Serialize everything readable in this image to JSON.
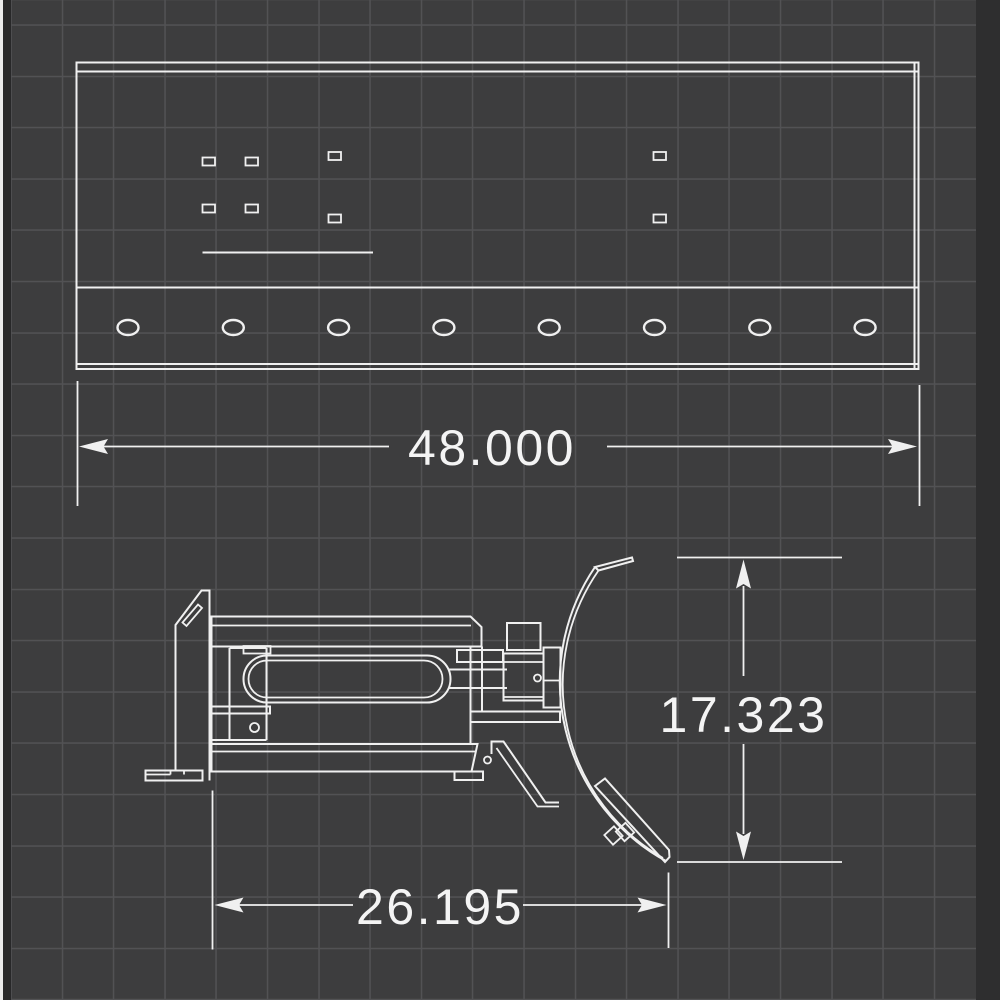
{
  "colors": {
    "background": "#3d3d3e",
    "grid": "#525254",
    "line": "#f0f0f0",
    "text": "#f4f4f4"
  },
  "dimensions": {
    "width_label": "48.000",
    "height_label": "17.323",
    "depth_label": "26.195"
  }
}
